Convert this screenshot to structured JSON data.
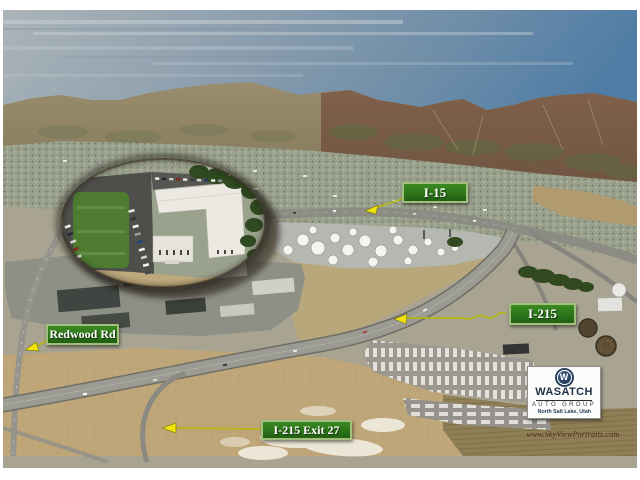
{
  "annotations": {
    "i15": {
      "label": "I-15"
    },
    "i215": {
      "label": "I-215"
    },
    "redwood_rd": {
      "label": "Redwood Rd"
    },
    "exit_27": {
      "label": "I-215 Exit 27"
    }
  },
  "logo": {
    "monogram": "W",
    "name": "WASATCH",
    "division": "AUTO GROUP",
    "location": "North Salt Lake, Utah"
  },
  "credit": {
    "url_text": "www.SkyViewPortraits.com"
  },
  "icons": {
    "callout_arrows": [
      "arrow-i15",
      "arrow-i215",
      "arrow-redwood-rd",
      "arrow-exit-27"
    ],
    "monogram_icon": "wasatch-w-circle"
  },
  "colors": {
    "label_background": "#2e7d1f",
    "label_border": "#a3bf7e",
    "label_text": "#ffffff",
    "arrow_yellow": "#f2e30c",
    "arrow_line": "#b4b612",
    "logo_navy": "#24405e",
    "frame_white": "#ffffff",
    "sky_blue": "#527ea6",
    "mountain_brown": "#7f604a",
    "field_tan": "#c0a878",
    "lawn_green": "#4e7d31"
  }
}
